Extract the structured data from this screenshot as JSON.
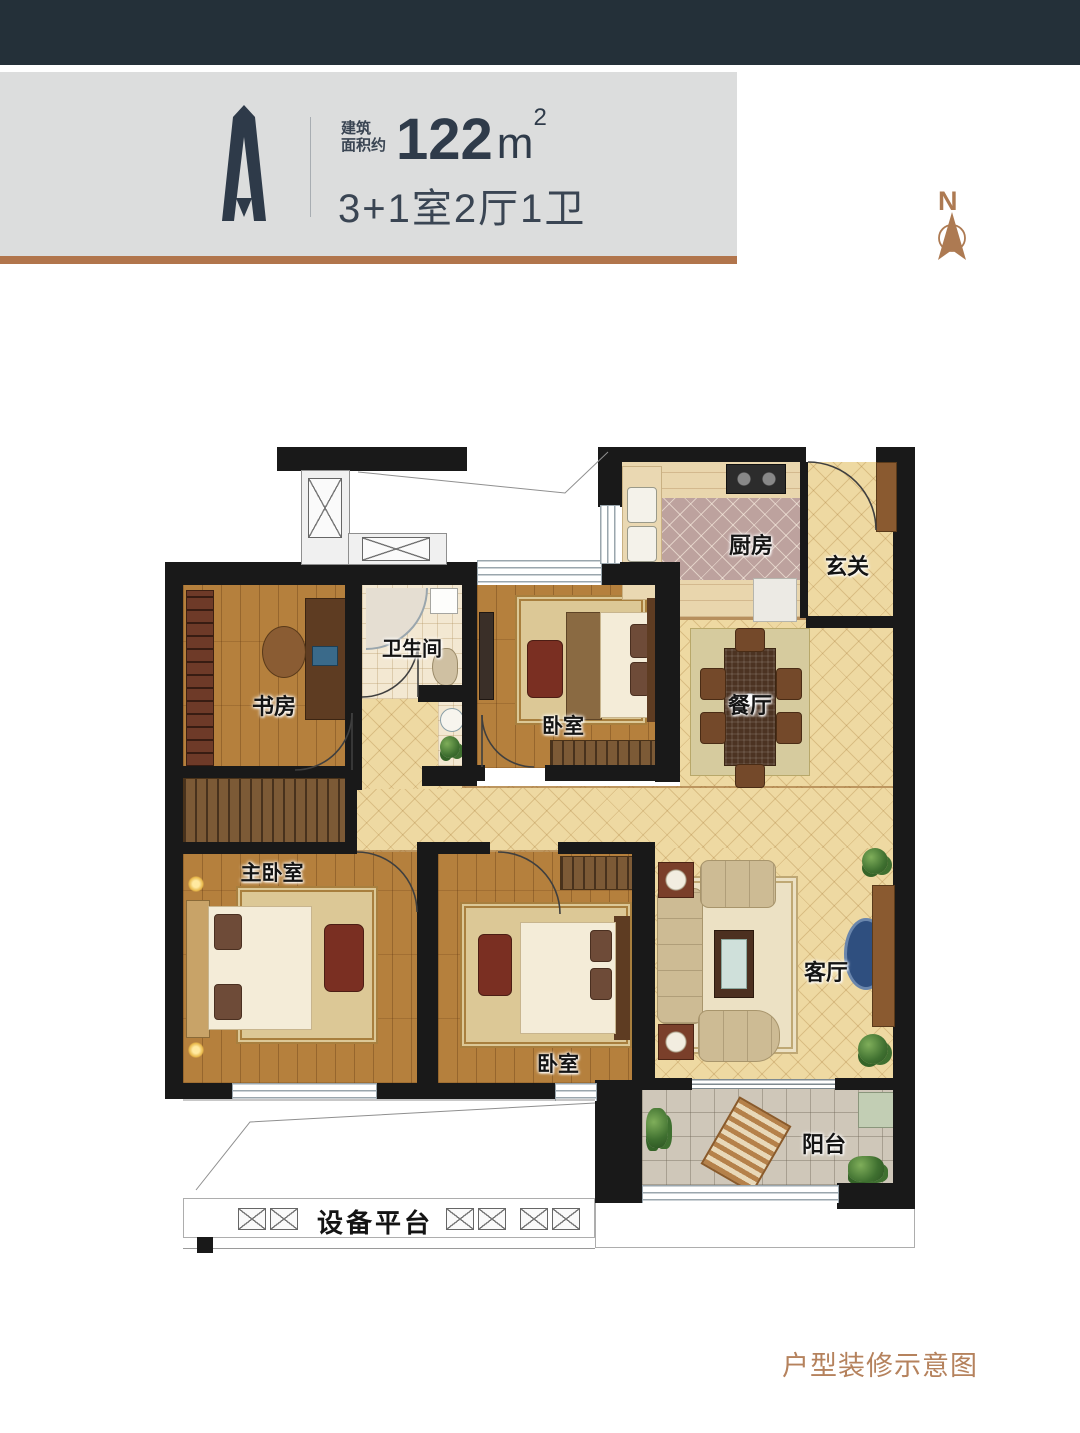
{
  "header": {
    "unit_mark": "A",
    "area_label_line1": "建筑",
    "area_label_line2": "面积约",
    "area_value": "122",
    "area_unit": "m",
    "area_exponent": "2",
    "spec": "3+1室2厅1卫"
  },
  "compass": {
    "north_label": "N"
  },
  "rooms": {
    "kitchen": "厨房",
    "entry": "玄关",
    "dining": "餐厅",
    "bathroom": "卫生间",
    "bedroom_north": "卧室",
    "study": "书房",
    "master_bedroom": "主卧室",
    "bedroom_south": "卧室",
    "living_room": "客厅",
    "balcony": "阳台",
    "equipment_platform": "设备平台"
  },
  "footer": {
    "caption": "户型装修示意图"
  },
  "colors": {
    "top_bar": "#243039",
    "panel_bg": "#dcdddd",
    "accent_brown": "#b1754c",
    "logo_navy": "#2e3a49",
    "compass_brown": "#ad7a52",
    "wall_black": "#191919",
    "floor_tan": "#eed9a2",
    "floor_wood": "#b5803d",
    "caption_brown": "#b5825d"
  }
}
